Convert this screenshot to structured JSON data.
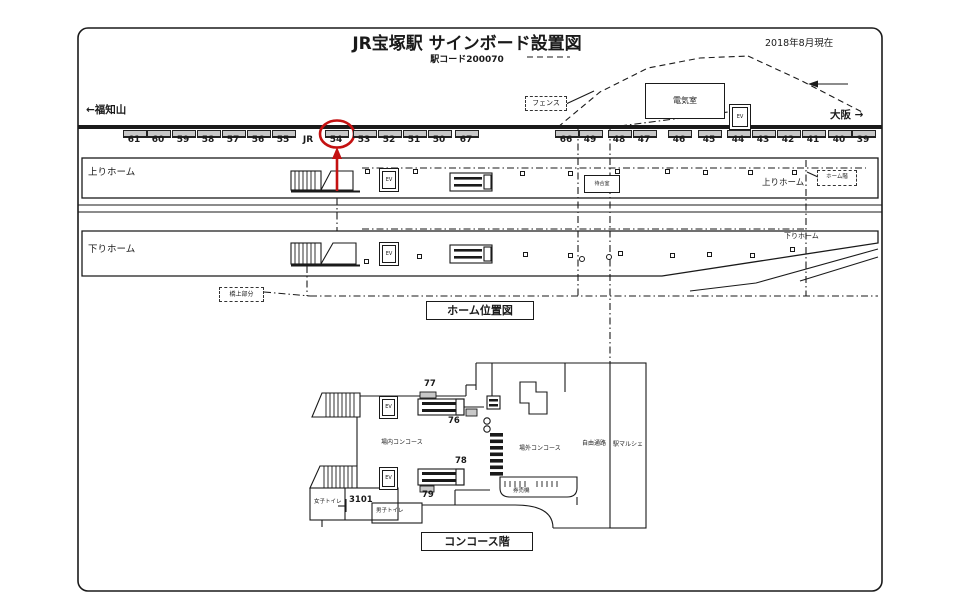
{
  "meta": {
    "title": "JR宝塚駅 サインボード設置図",
    "subtitle": "駅コード200070",
    "date_note": "2018年8月現在"
  },
  "directions": {
    "left_terminus": "←福知山",
    "right_terminus": "大阪 →"
  },
  "track_signboards": [
    {
      "label": "61",
      "x": 134
    },
    {
      "label": "60",
      "x": 158
    },
    {
      "label": "59",
      "x": 183
    },
    {
      "label": "58",
      "x": 208
    },
    {
      "label": "57",
      "x": 233
    },
    {
      "label": "56",
      "x": 258
    },
    {
      "label": "55",
      "x": 283
    },
    {
      "label": "JR",
      "x": 308,
      "board": false
    },
    {
      "label": "54",
      "x": 336,
      "circled": true
    },
    {
      "label": "53",
      "x": 364
    },
    {
      "label": "52",
      "x": 389
    },
    {
      "label": "51",
      "x": 414
    },
    {
      "label": "50",
      "x": 439
    },
    {
      "label": "67",
      "x": 466
    },
    {
      "label": "66",
      "x": 566
    },
    {
      "label": "49",
      "x": 590
    },
    {
      "label": "48",
      "x": 619
    },
    {
      "label": "47",
      "x": 644
    },
    {
      "label": "46",
      "x": 679
    },
    {
      "label": "45",
      "x": 709
    },
    {
      "label": "44",
      "x": 738
    },
    {
      "label": "43",
      "x": 763
    },
    {
      "label": "42",
      "x": 788
    },
    {
      "label": "41",
      "x": 813
    },
    {
      "label": "40",
      "x": 839
    },
    {
      "label": "39",
      "x": 863
    }
  ],
  "platform_map": {
    "caption": "ホーム位置図",
    "up_platform_left": "上りホーム",
    "up_platform_right": "上りホーム",
    "down_platform_left": "下りホーム",
    "down_platform_right": "下りホーム",
    "waiting_room": "待合室",
    "platform_floor": "ホーム階",
    "bridge_part": "橋上部分",
    "fence": "フェンス",
    "electric_room": "電気室",
    "upper_pillars": [
      [
        365,
        169
      ],
      [
        413,
        169
      ],
      [
        520,
        171
      ],
      [
        568,
        171
      ],
      [
        615,
        169
      ],
      [
        665,
        169
      ],
      [
        703,
        170
      ],
      [
        748,
        170
      ],
      [
        792,
        170
      ]
    ],
    "lower_pillars": [
      [
        364,
        259
      ],
      [
        417,
        254
      ],
      [
        523,
        252
      ],
      [
        568,
        253
      ],
      [
        618,
        251
      ],
      [
        670,
        253
      ],
      [
        707,
        252
      ],
      [
        750,
        253
      ],
      [
        790,
        247
      ]
    ],
    "lower_circles": [
      [
        579,
        256
      ],
      [
        606,
        254
      ]
    ]
  },
  "concourse_map": {
    "caption": "コンコース階",
    "inside_concourse": "場内コンコース",
    "outside_concourse": "場外コンコース",
    "free_passage": "自由通路",
    "station_marche": "駅マルシェ",
    "ticket_machines": "券売機",
    "womens_toilet": "女子トイレ",
    "mens_toilet": "男子トイレ",
    "signs": [
      {
        "label": "77"
      },
      {
        "label": "76"
      },
      {
        "label": "78"
      },
      {
        "label": "79"
      },
      {
        "label": "3101"
      }
    ]
  },
  "labels": {
    "ev": "EV"
  },
  "colors": {
    "highlight": "#c41111",
    "board_fill": "#c8c8c8",
    "line": "#1a1a1a"
  }
}
